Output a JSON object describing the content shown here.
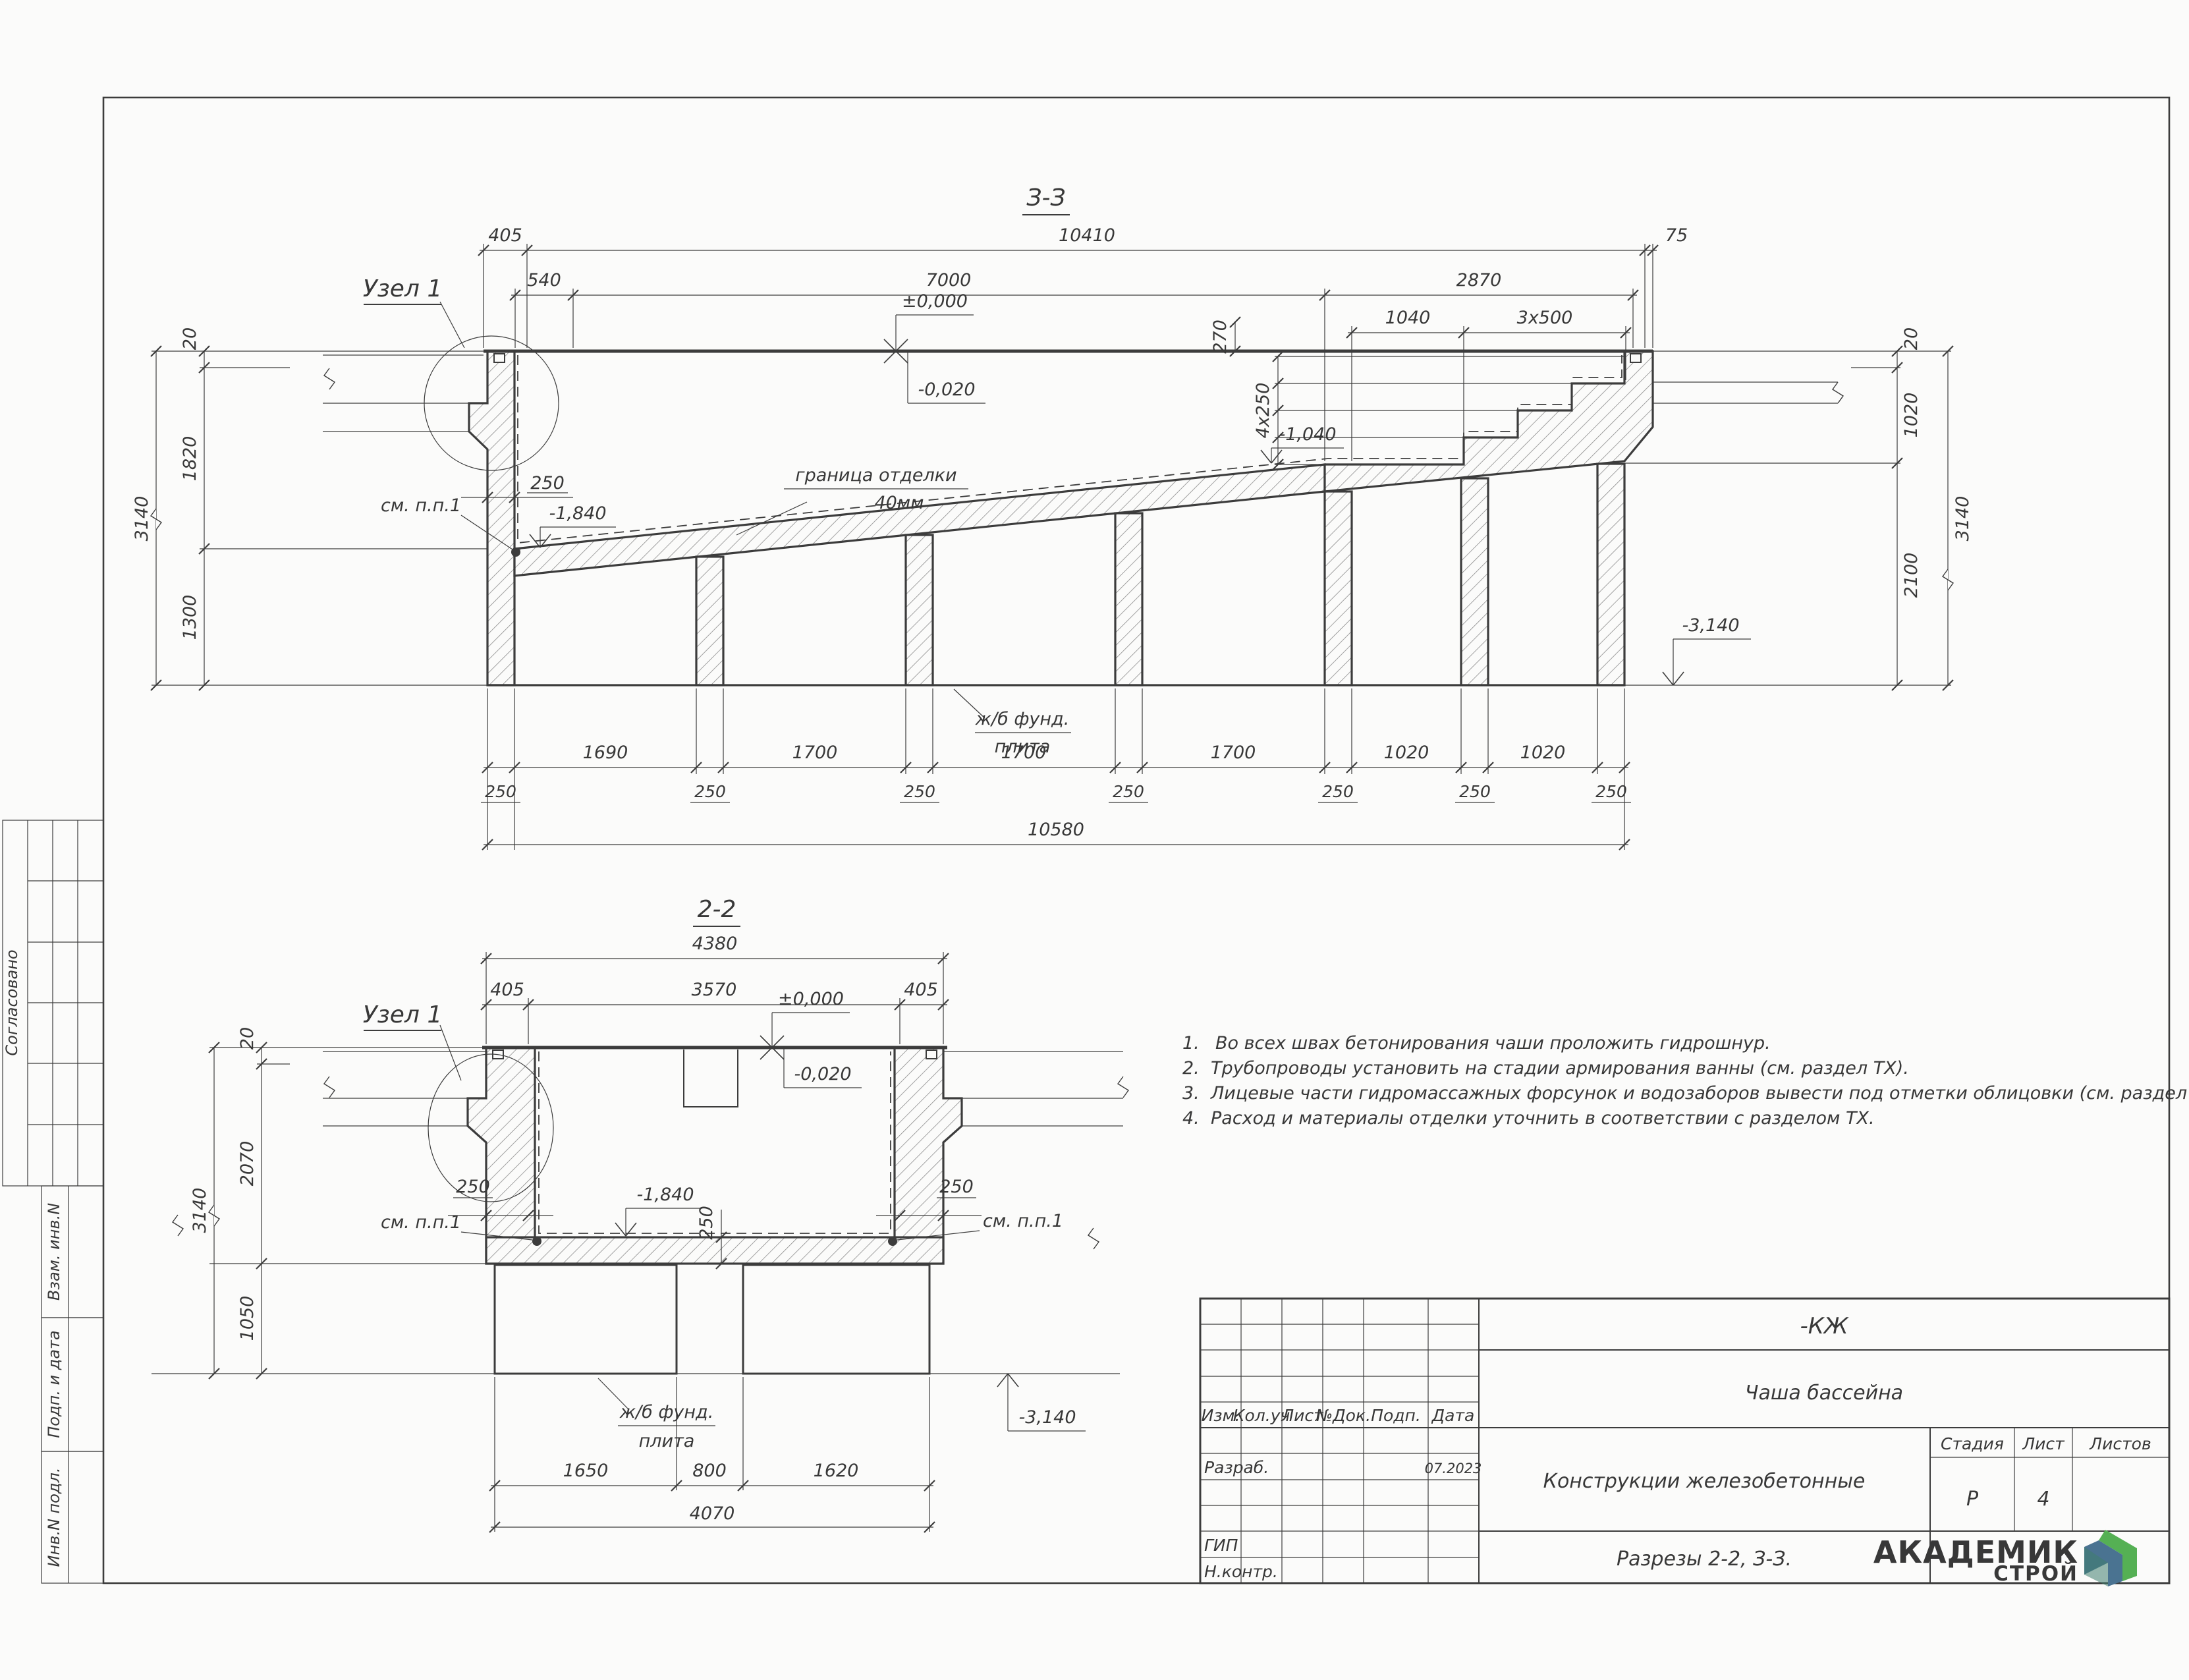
{
  "side_stamps": {
    "soglasovano": "Согласовано",
    "vzam": "Взам. инв.N",
    "podp": "Подп. и дата",
    "inv": "Инв.N подл."
  },
  "section33": {
    "title": "З-З",
    "dims": {
      "top_405": "405",
      "top_10410": "10410",
      "top_75": "75",
      "row2_540": "540",
      "row2_7000": "7000",
      "row2_2870": "2870",
      "row3_1040": "1040",
      "row3_3x500": "3x500",
      "v_270": "270",
      "v_4x250": "4x250",
      "left_20": "20",
      "left_1820": "1820",
      "left_1300": "1300",
      "left_3140": "3140",
      "right_20": "20",
      "right_1020": "1020",
      "right_2100": "2100",
      "right_3140": "3140",
      "wall_250": "250",
      "d250": "250",
      "bottom": [
        "1690",
        "1700",
        "1700",
        "1700",
        "1020",
        "1020"
      ],
      "bottom_total": "10580"
    },
    "levels": {
      "zero": "±0,000",
      "m020": "-0,020",
      "m1040": "-1,040",
      "m1840": "-1,840",
      "m3140": "-3,140"
    },
    "labels": {
      "uzel1": "Узел 1",
      "sm_pp1": "см. п.п.1",
      "granica_line1": "граница отделки",
      "granica_line2": "40мм",
      "fund_line1": "ж/б фунд.",
      "fund_line2": "плита"
    }
  },
  "section22": {
    "title": "2-2",
    "dims": {
      "top_4380": "4380",
      "row2_405l": "405",
      "row2_3570": "3570",
      "row2_405r": "405",
      "left_20": "20",
      "left_2070": "2070",
      "left_1050": "1050",
      "left_3140": "3140",
      "wall_250l": "250",
      "wall_250r": "250",
      "slab_250": "250",
      "bottom_1650": "1650",
      "bottom_800": "800",
      "bottom_1620": "1620",
      "bottom_total": "4070"
    },
    "levels": {
      "zero": "±0,000",
      "m020": "-0,020",
      "m1840": "-1,840",
      "m3140": "-3,140"
    },
    "labels": {
      "uzel1": "Узел 1",
      "sm_pp1_l": "см. п.п.1",
      "sm_pp1_r": "см. п.п.1",
      "fund_line1": "ж/б фунд.",
      "fund_line2": "плита"
    }
  },
  "notes": {
    "items": [
      {
        "num": "1.",
        "text": "Во всех швах бетонирования чаши проложить гидрошнур."
      },
      {
        "num": "2.",
        "text": "Трубопроводы установить на стадии армирования ванны (см. раздел ТХ)."
      },
      {
        "num": "3.",
        "text": "Лицевые части гидромассажных форсунок и водозаборов вывести под отметки облицовки (см. раздел ТХ)."
      },
      {
        "num": "4.",
        "text": "Расход и материалы отделки уточнить в соответствии с разделом ТХ."
      }
    ]
  },
  "titleblock": {
    "code": "-КЖ",
    "object": "Чаша бассейна",
    "doc_title": "Конструкции железобетонные",
    "sheet_title": "Разрезы 2-2, З-З.",
    "stage_label": "Стадия",
    "sheet_label": "Лист",
    "sheets_label": "Листов",
    "stage_value": "Р",
    "sheet_value": "4",
    "header": {
      "izm": "Изм.",
      "koluch": "Кол.уч",
      "list": "Лист",
      "ndok": "№Док.",
      "podp": "Подп.",
      "data": "Дата"
    },
    "rows": {
      "razrab": "Разраб.",
      "gip": "ГИП",
      "nkontr": "Н.контр."
    },
    "date": "07.2023"
  },
  "logo": {
    "name": "АКАДЕМИК",
    "sub": "СТРОЙ",
    "green": "#47a84e",
    "teal": "#2f9e8c",
    "icon_green": "#55b054",
    "icon_blue": "#4a7391"
  }
}
